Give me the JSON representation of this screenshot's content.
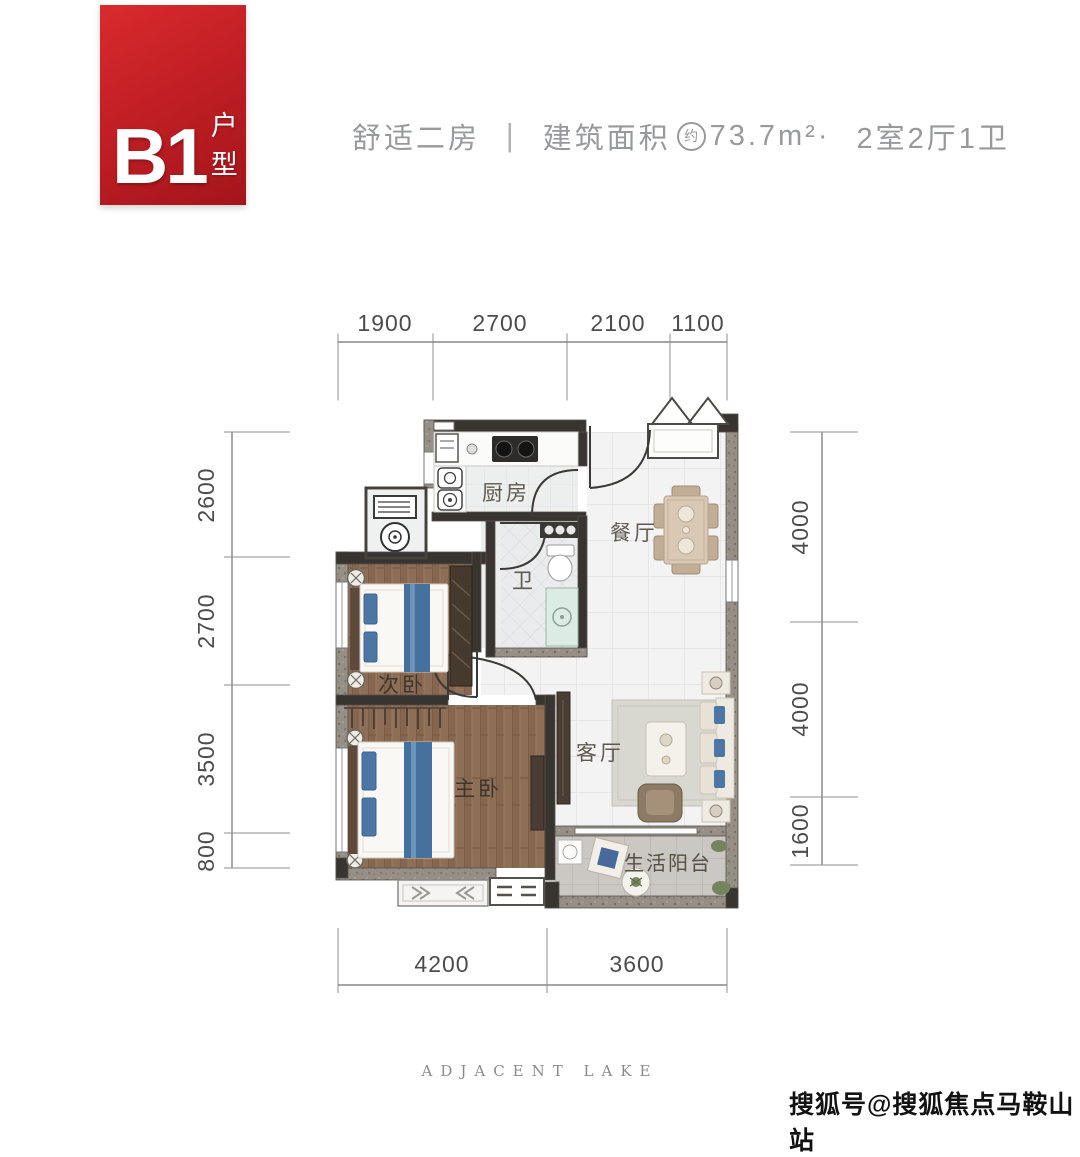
{
  "badge": {
    "code": "B1",
    "suffix": "户型"
  },
  "header": {
    "tagline": "舒适二房",
    "separator": "|",
    "area_label": "建筑面积",
    "area_qualifier": "约",
    "area_value": "73.7m²",
    "middot": "·",
    "layout": "2室2厅1卫"
  },
  "plan": {
    "rooms": {
      "kitchen": {
        "label": "厨房"
      },
      "dining": {
        "label": "餐厅"
      },
      "bath": {
        "label": "卫"
      },
      "bedroom2": {
        "label": "次卧"
      },
      "master": {
        "label": "主卧"
      },
      "living": {
        "label": "客厅"
      },
      "balcony": {
        "label": "生活阳台"
      }
    },
    "dimensions": {
      "top": [
        "1900",
        "2700",
        "2100",
        "1100"
      ],
      "left": [
        "2600",
        "2700",
        "3500",
        "800"
      ],
      "right": [
        "4000",
        "4000",
        "1600"
      ],
      "bottom": [
        "4200",
        "3600"
      ]
    }
  },
  "footer": {
    "brand": "ADJACENT  LAKE"
  },
  "watermark": {
    "text": "搜狐号@搜狐焦点马鞍山站"
  },
  "colors": {
    "accent_red": "#c42026",
    "wall_dark": "#38342f",
    "wall_exterior": "#968f86",
    "wood_floor": "#8d6e57",
    "tile_floor": "#f3f3f4",
    "header_text": "#98999b",
    "dim_text": "#4c4c4c",
    "pillow_blue": "#4c77a4"
  }
}
